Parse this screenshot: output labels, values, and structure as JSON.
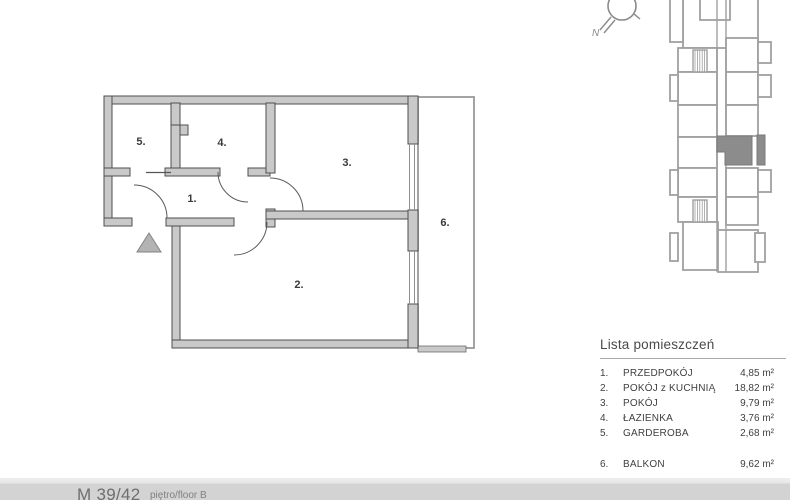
{
  "floor_plan": {
    "room_labels": [
      {
        "id": "1",
        "label": "1."
      },
      {
        "id": "2",
        "label": "2."
      },
      {
        "id": "3",
        "label": "3."
      },
      {
        "id": "4",
        "label": "4."
      },
      {
        "id": "5",
        "label": "5."
      },
      {
        "id": "6",
        "label": "6."
      }
    ]
  },
  "compass": {
    "north_label": "N"
  },
  "room_list": {
    "title": "Lista pomieszczeń",
    "rows": [
      {
        "no": "1.",
        "name": "PRZEDPOKÓJ",
        "area": "4,85 m²"
      },
      {
        "no": "2.",
        "name": "POKÓJ z KUCHNIĄ",
        "area": "18,82 m²"
      },
      {
        "no": "3.",
        "name": "POKÓJ",
        "area": "9,79 m²"
      },
      {
        "no": "4.",
        "name": "ŁAZIENKA",
        "area": "3,76 m²"
      },
      {
        "no": "5.",
        "name": "GARDEROBA",
        "area": "2,68 m²"
      },
      {
        "no": "6.",
        "name": "BALKON",
        "area": "9,62 m²"
      }
    ]
  },
  "footer": {
    "unit_label": "M 39/42",
    "sub_label": "piętro/floor B"
  },
  "colors": {
    "wall_fill": "#c9c9c9",
    "wall_stroke": "#4f4f4f",
    "keyplan_stroke": "#a0a0a0",
    "highlight_fill": "#8c8c8c",
    "footer_bg": "#d3d3d3"
  }
}
